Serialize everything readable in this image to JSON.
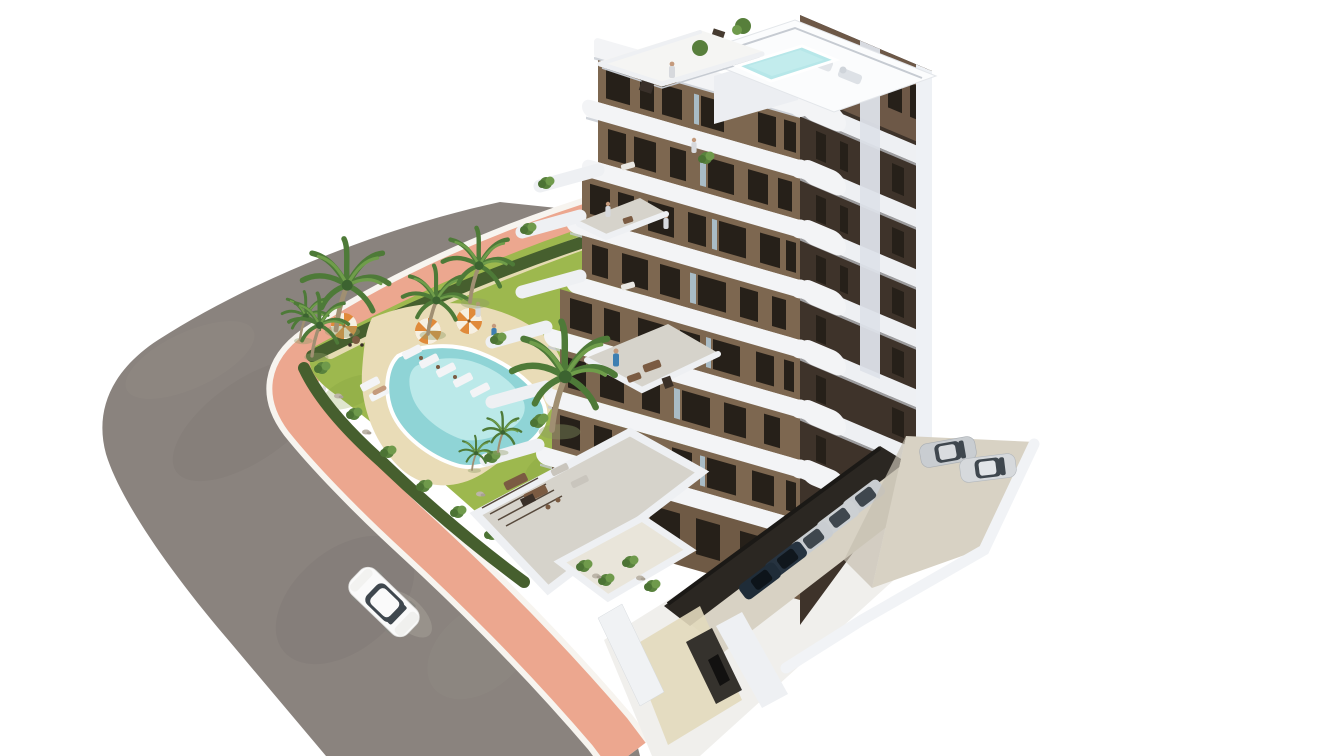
{
  "image": {
    "kind": "3d-architectural-render",
    "description": "Aerial 3D render of a modern white and brown apartment block with rounded white balconies and rooftop terraces with a plunge pool, a landscaped garden with a free-form swimming pool, palm trees, sun loungers and striped parasols, a curved grey asphalt road with a salmon-pink sidewalk, one white car driving on the road, two silver cars in an open parking area and dark cars in covered parking under the building, all on a plain white background.",
    "background": "white"
  },
  "counts": {
    "building_floors_visible": 8,
    "palm_trees": 8,
    "garden_parasols": 3,
    "sun_loungers": 7,
    "people": 9,
    "street_cars": 1,
    "open_parking_cars": 2,
    "covered_parking_cars": 5,
    "swimming_pools": 2
  },
  "colors": {
    "background": "#ffffff",
    "road": "#8a837e",
    "road_dark": "#7b746f",
    "road_light": "#989088",
    "sidewalk": "#eca78f",
    "curb": "#f7f4ef",
    "hedge": "#465f2e",
    "lawn": "#9db84e",
    "lawn_dark": "#7f9c3c",
    "sand": "#e9dcb7",
    "pool_water": "#8fd4d6",
    "pool_water_light": "#c6eeee",
    "pool_rim": "#ffffff",
    "roof_pool": "#b7e7e9",
    "palm_green": "#4e7a38",
    "palm_green_light": "#6f9d4a",
    "palm_trunk": "#a08f72",
    "slab_white": "#f3f4f6",
    "slab_shade": "#c6cbd2",
    "building_white": "#eef0f3",
    "wall_brown": "#7d6750",
    "wall_ground": "#6f5a45",
    "face_dark": "#3e332a",
    "face_upper": "#6d5847",
    "window_dark": "#262019",
    "glass_light": "#a9bcc6",
    "undercroft": "#2b2722",
    "concrete": "#d8d2c4",
    "terrace_floor": "#d6d3cb",
    "walkway": "#e2d9bd",
    "boundary_wall": "#f1f3f6",
    "shadow": "#a9a39b",
    "car_white": "#fafafa",
    "car_silver": "#c9cdd1",
    "car_glass": "#3f474e",
    "car_dark": "#263340",
    "umbrella": "#e08a3a",
    "umbrella_white": "#f6f0e2",
    "furniture_brown": "#7b5b42",
    "furniture_dark": "#3a3028",
    "person_blue": "#3e7fb2",
    "person_teal": "#2f9aa8",
    "person_gray": "#d7d9dd",
    "person_skin": "#c49a7c"
  }
}
